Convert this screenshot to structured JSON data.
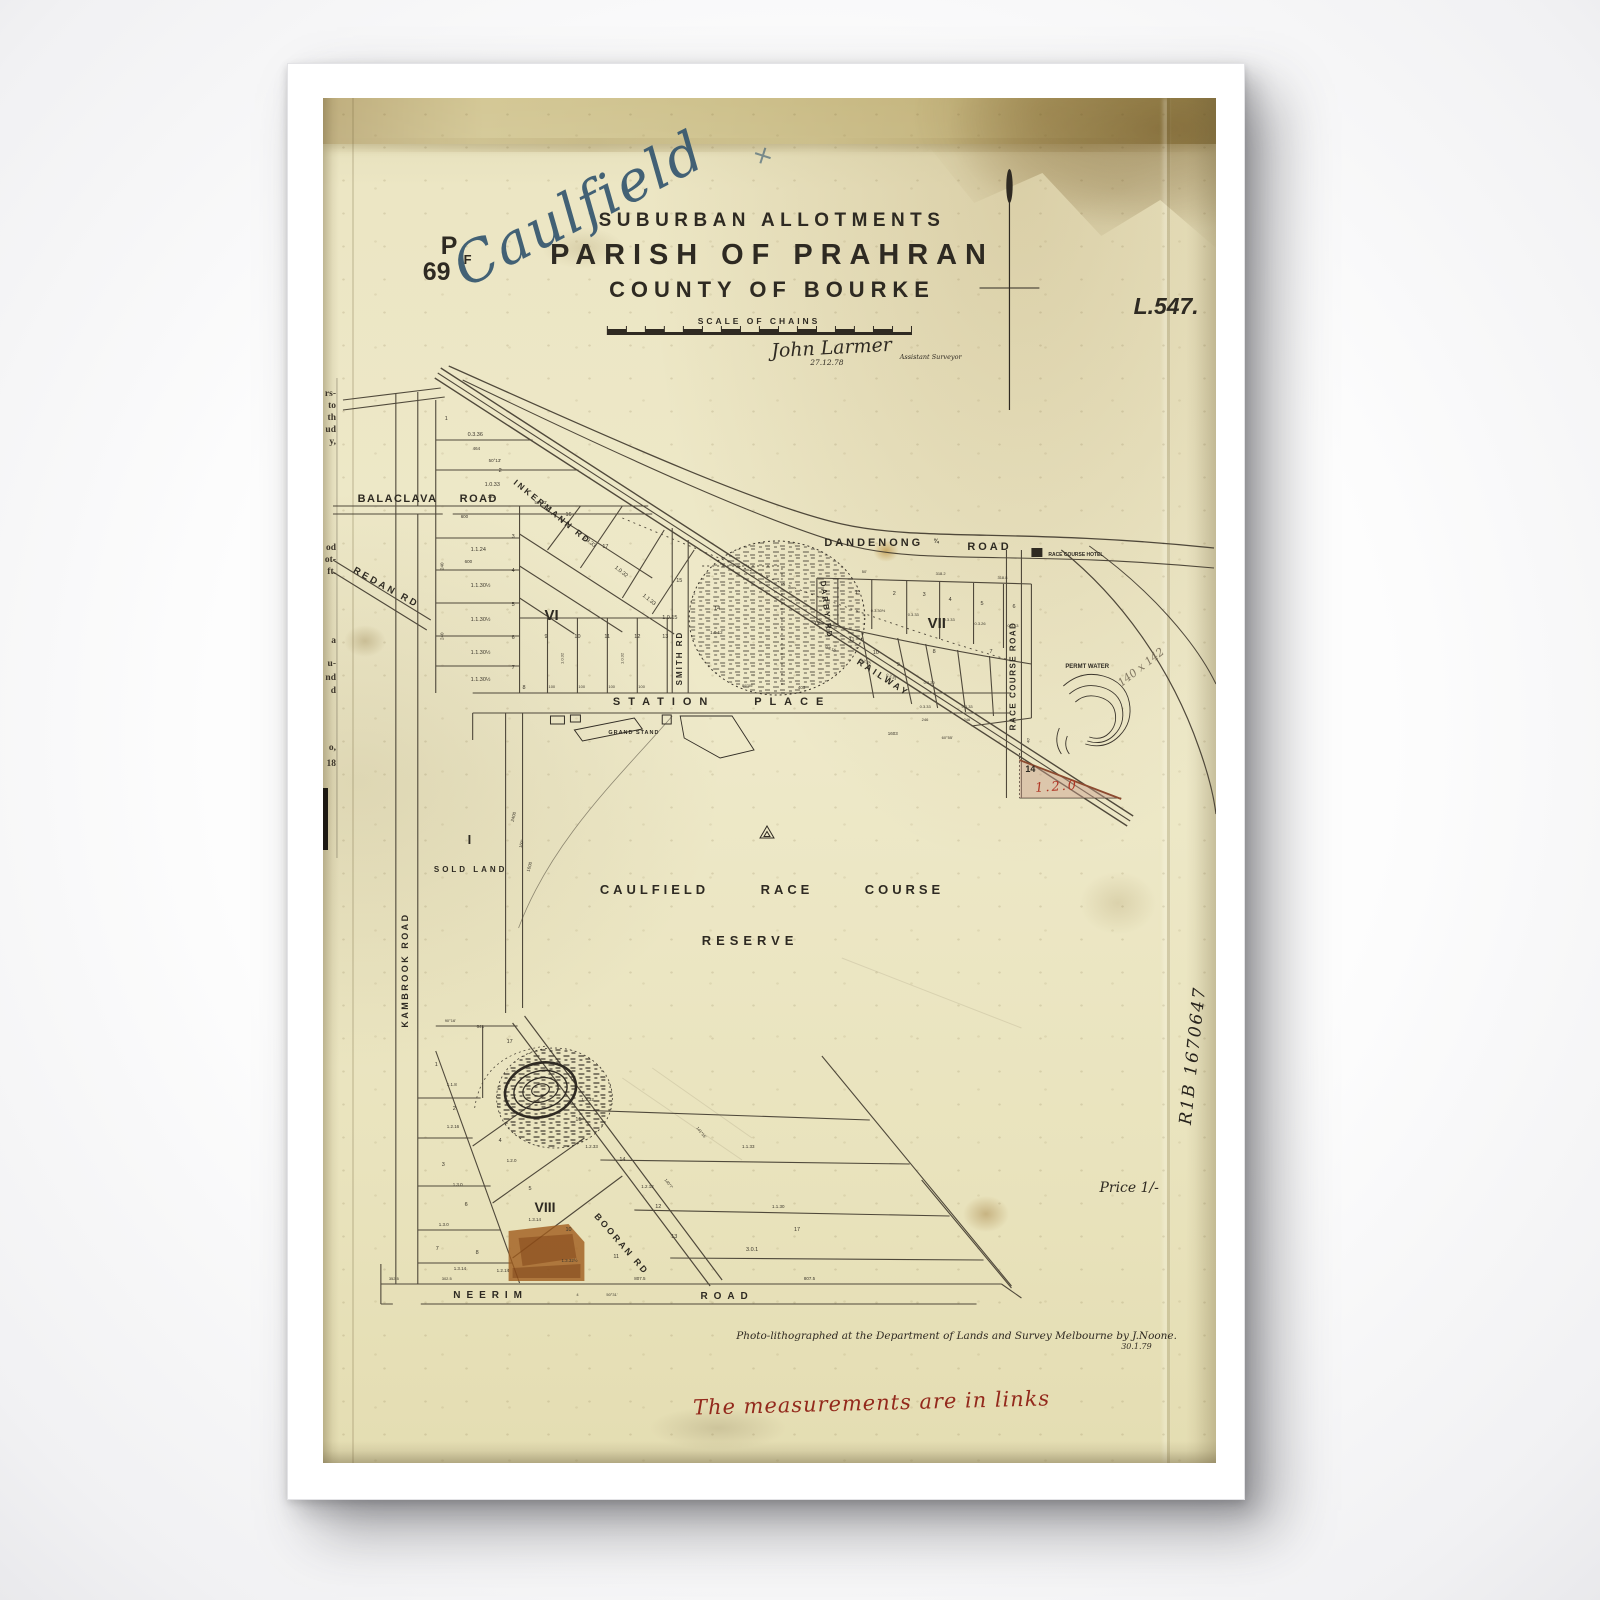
{
  "document": {
    "handwritten_title": "Caulfield",
    "handwritten_cross": "+",
    "plan_prefix": "P",
    "plan_number": "69",
    "plan_suffix": "F",
    "record_number": "L.547.",
    "title_line1": "SUBURBAN ALLOTMENTS",
    "title_line2": "PARISH OF PRAHRAN",
    "title_line3": "COUNTY OF BOURKE",
    "scale_label": "SCALE OF CHAINS",
    "surveyor_signature": "John Larmer",
    "survey_date": "27.12.78",
    "surveyor_role": "Assistant Surveyor"
  },
  "map": {
    "roads": {
      "balaclava": "BALACLAVA ROAD",
      "redan": "REDAN RD",
      "inkerman": "INKERMANN RD",
      "dandenong": "DANDENONG",
      "dandenong_fraction": "¾",
      "dandenong_road_word": "ROAD",
      "station_place": "STATION PLACE",
      "smith": "SMITH RD",
      "darby": "DARBY RD",
      "railway": "RAILWAY",
      "race_course_road": "RACE COURSE ROAD",
      "kambrook": "KAMBROOK ROAD",
      "neerim": "NEERIM",
      "neerim_road_word": "ROAD",
      "booran": "BOORAN RD"
    },
    "sections": {
      "vi": "VI",
      "vii": "VII",
      "viii": "VIII",
      "i": "I"
    },
    "labels": {
      "sold_land": "SOLD LAND",
      "race_course_line1": "CAULFIELD RACE COURSE",
      "race_course_line2": "RESERVE",
      "grand_stand": "GRAND STAND",
      "hotel": "RACE COURSE HOTEL",
      "perm_water": "PERMT WATER",
      "lot14": "14",
      "lot14_area_red": "1.2.0",
      "pencil_note": "140 x 142"
    },
    "markers": [
      {
        "t": "1",
        "x": 122,
        "y": 322
      },
      {
        "t": "0.3.36",
        "x": 145,
        "y": 338
      },
      {
        "t": "464",
        "x": 150,
        "y": 352,
        "s": 4.5
      },
      {
        "t": "50°13'",
        "x": 166,
        "y": 364,
        "s": 4.5
      },
      {
        "t": "2",
        "x": 176,
        "y": 374
      },
      {
        "t": "1.0.33",
        "x": 162,
        "y": 388
      },
      {
        "t": "222",
        "x": 165,
        "y": 400,
        "s": 4.5
      },
      {
        "t": "50°13'",
        "x": 212,
        "y": 406,
        "s": 4.5
      },
      {
        "t": "600",
        "x": 138,
        "y": 420,
        "s": 4.5
      },
      {
        "t": "3",
        "x": 189,
        "y": 440
      },
      {
        "t": "1.1.24",
        "x": 148,
        "y": 453
      },
      {
        "t": "600",
        "x": 142,
        "y": 465,
        "s": 4.5
      },
      {
        "t": "4",
        "x": 189,
        "y": 474
      },
      {
        "t": "1.1.30½",
        "x": 148,
        "y": 489
      },
      {
        "t": "240",
        "x": 121,
        "y": 472,
        "r": -90,
        "s": 4.5
      },
      {
        "t": "5",
        "x": 189,
        "y": 508
      },
      {
        "t": "1.1.30½",
        "x": 148,
        "y": 523
      },
      {
        "t": "240",
        "x": 121,
        "y": 542,
        "r": -90,
        "s": 4.5
      },
      {
        "t": "6",
        "x": 189,
        "y": 541
      },
      {
        "t": "1.1.30½",
        "x": 148,
        "y": 556
      },
      {
        "t": "7",
        "x": 189,
        "y": 571
      },
      {
        "t": "1.1.30½",
        "x": 148,
        "y": 583
      },
      {
        "t": "8",
        "x": 200,
        "y": 591
      },
      {
        "t": "16",
        "x": 243,
        "y": 418,
        "s": 5.5
      },
      {
        "t": "0.3.33",
        "x": 260,
        "y": 440,
        "r": 39
      },
      {
        "t": "17",
        "x": 280,
        "y": 450,
        "s": 5.5
      },
      {
        "t": "1.0.32",
        "x": 292,
        "y": 470,
        "r": 39
      },
      {
        "t": "1.1.33",
        "x": 320,
        "y": 498,
        "r": 39
      },
      {
        "t": "15",
        "x": 354,
        "y": 484,
        "s": 5.5
      },
      {
        "t": "1.0.15",
        "x": 340,
        "y": 521
      },
      {
        "t": "14",
        "x": 392,
        "y": 512,
        "s": 5.5
      },
      {
        "t": "1.0.12",
        "x": 388,
        "y": 536,
        "s": 4.5
      },
      {
        "t": "9",
        "x": 222,
        "y": 540,
        "s": 5.5
      },
      {
        "t": "10",
        "x": 252,
        "y": 540,
        "s": 5.5
      },
      {
        "t": "11",
        "x": 282,
        "y": 540,
        "s": 5.5
      },
      {
        "t": "12",
        "x": 312,
        "y": 540,
        "s": 5.5
      },
      {
        "t": "13",
        "x": 340,
        "y": 540,
        "s": 5.5
      },
      {
        "t": "1.0.32",
        "x": 241,
        "y": 566,
        "r": -90,
        "s": 4
      },
      {
        "t": "1.0.32",
        "x": 301,
        "y": 566,
        "r": -90,
        "s": 4
      },
      {
        "t": "100",
        "x": 226,
        "y": 590,
        "s": 4
      },
      {
        "t": "100",
        "x": 256,
        "y": 590,
        "s": 4
      },
      {
        "t": "100",
        "x": 286,
        "y": 590,
        "s": 4
      },
      {
        "t": "100",
        "x": 316,
        "y": 590,
        "s": 4
      },
      {
        "t": "89°55'",
        "x": 420,
        "y": 589,
        "s": 4
      },
      {
        "t": "403",
        "x": 476,
        "y": 591,
        "s": 4.5
      },
      {
        "t": "50'",
        "x": 540,
        "y": 475,
        "s": 4
      },
      {
        "t": "318.2",
        "x": 614,
        "y": 477,
        "s": 4
      },
      {
        "t": "318.8",
        "x": 676,
        "y": 481,
        "s": 4
      },
      {
        "t": "1",
        "x": 533,
        "y": 496,
        "s": 5.5
      },
      {
        "t": "2",
        "x": 571,
        "y": 497,
        "s": 5.5
      },
      {
        "t": "3",
        "x": 601,
        "y": 498,
        "s": 5.5
      },
      {
        "t": "4",
        "x": 627,
        "y": 503,
        "s": 5.5
      },
      {
        "t": "5",
        "x": 659,
        "y": 507,
        "s": 5.5
      },
      {
        "t": "6",
        "x": 691,
        "y": 510,
        "s": 5.5
      },
      {
        "t": "0.3.30½",
        "x": 549,
        "y": 514,
        "s": 4
      },
      {
        "t": "0.3.33",
        "x": 586,
        "y": 518,
        "s": 4
      },
      {
        "t": "0.3.33",
        "x": 622,
        "y": 523,
        "s": 4
      },
      {
        "t": "0.3.26",
        "x": 653,
        "y": 527,
        "s": 4
      },
      {
        "t": "0.3.13",
        "x": 686,
        "y": 529,
        "s": 4
      },
      {
        "t": "12",
        "x": 492,
        "y": 527,
        "s": 5.5
      },
      {
        "t": "11",
        "x": 527,
        "y": 543,
        "s": 5.5
      },
      {
        "t": "10",
        "x": 551,
        "y": 556,
        "s": 5.5
      },
      {
        "t": "9",
        "x": 575,
        "y": 568,
        "s": 5.5
      },
      {
        "t": "8",
        "x": 611,
        "y": 555,
        "s": 5.5
      },
      {
        "t": "7",
        "x": 668,
        "y": 555,
        "s": 5.5
      },
      {
        "t": "0.3.16",
        "x": 503,
        "y": 550,
        "r": 20,
        "s": 4
      },
      {
        "t": "0.3.25",
        "x": 538,
        "y": 563,
        "r": 20,
        "s": 4
      },
      {
        "t": "0.3.31",
        "x": 564,
        "y": 578,
        "r": 20,
        "s": 4
      },
      {
        "t": "0.3.20",
        "x": 602,
        "y": 586,
        "s": 4
      },
      {
        "t": "0.3.33",
        "x": 598,
        "y": 610,
        "s": 4
      },
      {
        "t": "0.3.33",
        "x": 640,
        "y": 610,
        "s": 4
      },
      {
        "t": "246",
        "x": 600,
        "y": 623,
        "s": 4
      },
      {
        "t": "246",
        "x": 642,
        "y": 623,
        "s": 4
      },
      {
        "t": "60°55'",
        "x": 620,
        "y": 641,
        "s": 4
      },
      {
        "t": "1603",
        "x": 566,
        "y": 637,
        "s": 4.5
      },
      {
        "t": "40'",
        "x": 708,
        "y": 645,
        "r": -90,
        "s": 4
      },
      {
        "t": "2400",
        "x": 191,
        "y": 724,
        "r": -75,
        "s": 4.5
      },
      {
        "t": "160°",
        "x": 199,
        "y": 750,
        "r": -75,
        "s": 4
      },
      {
        "t": "1600",
        "x": 207,
        "y": 774,
        "r": -75,
        "s": 4.5
      },
      {
        "t": "90°16'",
        "x": 122,
        "y": 924,
        "s": 4
      },
      {
        "t": "641",
        "x": 154,
        "y": 930,
        "s": 4.5
      },
      {
        "t": "17",
        "x": 184,
        "y": 945,
        "s": 5.5
      },
      {
        "t": "1",
        "x": 112,
        "y": 968,
        "s": 5.5
      },
      {
        "t": "1.1.8",
        "x": 124,
        "y": 988,
        "s": 4.5
      },
      {
        "t": "2",
        "x": 130,
        "y": 1012,
        "s": 5.5
      },
      {
        "t": "1.2.16",
        "x": 124,
        "y": 1030,
        "s": 4.5
      },
      {
        "t": "3",
        "x": 119,
        "y": 1068,
        "s": 5.5
      },
      {
        "t": "1.3.0",
        "x": 130,
        "y": 1088,
        "s": 4.5
      },
      {
        "t": "1.3.0",
        "x": 116,
        "y": 1128,
        "s": 4.5
      },
      {
        "t": "6",
        "x": 142,
        "y": 1108,
        "s": 5.5
      },
      {
        "t": "7",
        "x": 113,
        "y": 1152,
        "s": 5.5
      },
      {
        "t": "8",
        "x": 153,
        "y": 1156,
        "s": 5.5
      },
      {
        "t": "1.3.14",
        "x": 131,
        "y": 1172,
        "s": 4.5
      },
      {
        "t": "1.2.14",
        "x": 174,
        "y": 1174,
        "s": 4.5
      },
      {
        "t": "4",
        "x": 176,
        "y": 1044,
        "s": 5.5
      },
      {
        "t": "1.2.0",
        "x": 184,
        "y": 1064,
        "s": 4.5
      },
      {
        "t": "5",
        "x": 206,
        "y": 1092,
        "s": 5.5
      },
      {
        "t": "15",
        "x": 253,
        "y": 1023,
        "s": 5.5
      },
      {
        "t": "1.2.32",
        "x": 259,
        "y": 1003,
        "s": 4.5
      },
      {
        "t": "1.2.33",
        "x": 263,
        "y": 1050,
        "s": 4.5
      },
      {
        "t": "14",
        "x": 297,
        "y": 1063,
        "s": 5.5
      },
      {
        "t": "1.2.12",
        "x": 319,
        "y": 1090,
        "s": 4.5
      },
      {
        "t": "12",
        "x": 333,
        "y": 1110,
        "s": 5.5
      },
      {
        "t": "13",
        "x": 349,
        "y": 1140,
        "s": 5.5
      },
      {
        "t": "10",
        "x": 243,
        "y": 1133,
        "s": 5.5
      },
      {
        "t": "1.3.14",
        "x": 206,
        "y": 1123,
        "s": 4.5
      },
      {
        "t": "11",
        "x": 291,
        "y": 1160,
        "s": 5.5
      },
      {
        "t": "1.3.32½",
        "x": 239,
        "y": 1164,
        "s": 4.5
      },
      {
        "t": "3.0.1",
        "x": 424,
        "y": 1153,
        "s": 5.5
      },
      {
        "t": "1.1.30",
        "x": 450,
        "y": 1110,
        "s": 4.5
      },
      {
        "t": "1.1.33",
        "x": 420,
        "y": 1050,
        "s": 4.5
      },
      {
        "t": "17",
        "x": 472,
        "y": 1133,
        "s": 5.5
      },
      {
        "t": "140°7'",
        "x": 342,
        "y": 1082,
        "r": 52,
        "s": 4
      },
      {
        "t": "141°16'",
        "x": 374,
        "y": 1030,
        "r": 52,
        "s": 4
      },
      {
        "t": "807.5",
        "x": 312,
        "y": 1182,
        "s": 4.5
      },
      {
        "t": "807.5",
        "x": 482,
        "y": 1182,
        "s": 4.5
      },
      {
        "t": "50°31'",
        "x": 284,
        "y": 1198,
        "s": 4
      },
      {
        "t": "4",
        "x": 254,
        "y": 1198,
        "s": 4
      },
      {
        "t": "302.5",
        "x": 119,
        "y": 1182,
        "s": 4
      },
      {
        "t": "352.5",
        "x": 66,
        "y": 1182,
        "s": 4
      }
    ]
  },
  "annotations": {
    "price": "Price 1/-",
    "litho_credit": "Photo-lithographed at the Department of Lands and Survey Melbourne by J.Noone.",
    "litho_date": "30.1.79",
    "measurement_note": "The measurements are in links",
    "side_reference": "R1B 1670647"
  },
  "margin_fragments": [
    {
      "t": "rs-",
      "y": 298
    },
    {
      "t": "to",
      "y": 310
    },
    {
      "t": "th",
      "y": 322
    },
    {
      "t": "ud",
      "y": 334
    },
    {
      "t": "y,",
      "y": 346
    },
    {
      "t": "od",
      "y": 452
    },
    {
      "t": "ot-",
      "y": 464
    },
    {
      "t": "ft.",
      "y": 476
    },
    {
      "t": "a",
      "y": 545
    },
    {
      "t": "u-",
      "y": 568
    },
    {
      "t": "nd",
      "y": 582
    },
    {
      "t": "d",
      "y": 595
    },
    {
      "t": "o,",
      "y": 652
    },
    {
      "t": "18",
      "y": 668
    }
  ]
}
